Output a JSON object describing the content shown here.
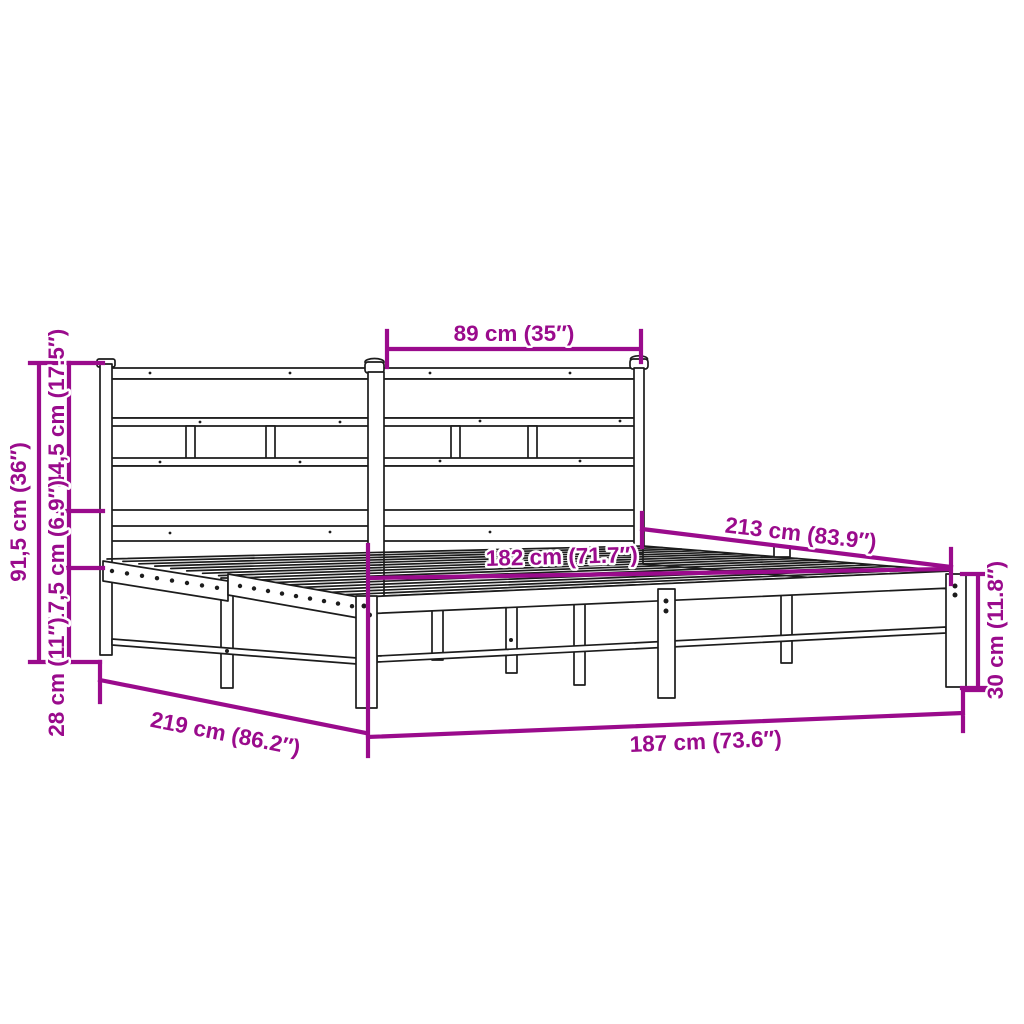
{
  "title": "Metal bed frame with headboard — dimension diagram",
  "colors": {
    "dimension": "#9A0B8C",
    "line_art": "#1c1c1c",
    "background": "#ffffff"
  },
  "dimensions": {
    "headboard_section_width": "89 cm (35″)",
    "total_height": "91,5 cm (36″)",
    "headboard_panel_height": "44,5 cm (17.5″)",
    "panel_to_frame_gap": "17,5 cm (6.9″)",
    "underbed_clearance": "28 cm (11″)",
    "inner_length": "213 cm (83.9″)",
    "inner_width": "182 cm (71.7″)",
    "total_length": "219 cm (86.2″)",
    "total_width": "187 cm (73.6″)",
    "frame_height": "30 cm (11.8″)"
  }
}
